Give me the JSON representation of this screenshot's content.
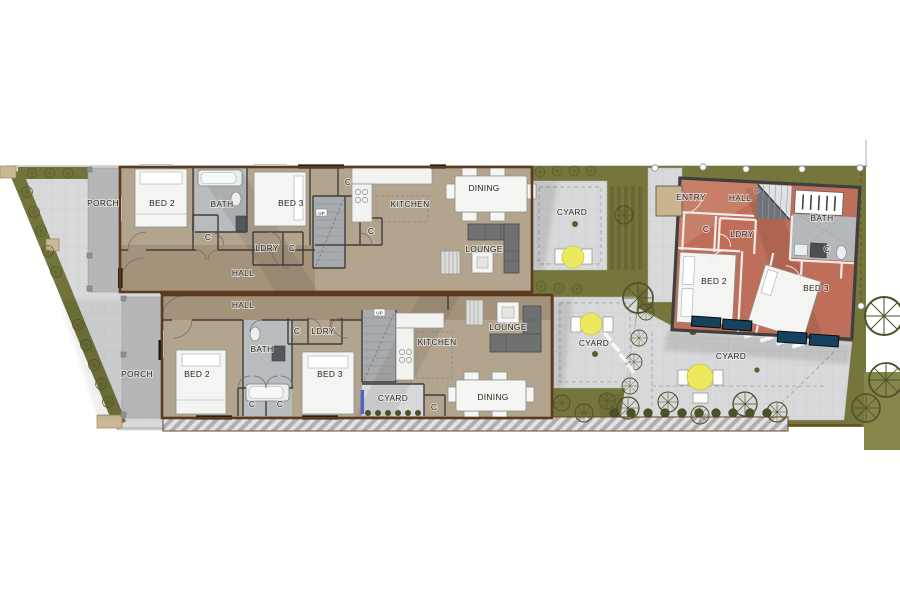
{
  "plan": {
    "unit_top": {
      "porch": "PORCH",
      "bed2": "BED 2",
      "bath": "BATH",
      "bed3": "BED 3",
      "closet1": "C",
      "ldry": "LDRY",
      "closet2": "C",
      "hall": "HALL",
      "closet3": "C",
      "kitchen": "KITCHEN",
      "dining": "DINING",
      "closet4": "C",
      "lounge": "LOUNGE",
      "up": "UP",
      "cyard": "CYARD"
    },
    "unit_bottom": {
      "hall": "HALL",
      "porch": "PORCH",
      "bed2": "BED 2",
      "bath": "BATH",
      "closet1": "C",
      "ldry": "LDRY",
      "bed3": "BED 3",
      "closet2": "C",
      "closet3": "C",
      "kitchen": "KITCHEN",
      "lounge": "LOUNGE",
      "cyard_small": "CYARD",
      "closet4": "C",
      "dining": "DINING",
      "up": "UP",
      "cyard": "CYARD"
    },
    "unit_rear": {
      "entry": "ENTRY",
      "hall": "HALL",
      "bath": "BATH",
      "closet1": "C",
      "ldry": "LDRY",
      "closet2": "C",
      "bed2": "BED 2",
      "bed3": "BED 3",
      "up": "UP",
      "cyard": "CYARD"
    }
  },
  "palette": {
    "floor_tan": "#b3a48e",
    "floor_tan_dark": "#a08f76",
    "floor_red": "#bf6f59",
    "floor_red_dark": "#a85a45",
    "paving": "#d8d9da",
    "porch_gray": "#b5b6b8",
    "lawn_olive": "#75763c",
    "garden_dark": "#4f512a",
    "wall_brown": "#5b3a1e",
    "wall_dark": "#3f3f3f",
    "window_teal": "#15425c",
    "table_yellow": "#ece95f",
    "bath_gray": "#b9bcbe",
    "entry_beige": "#c9b48e"
  }
}
